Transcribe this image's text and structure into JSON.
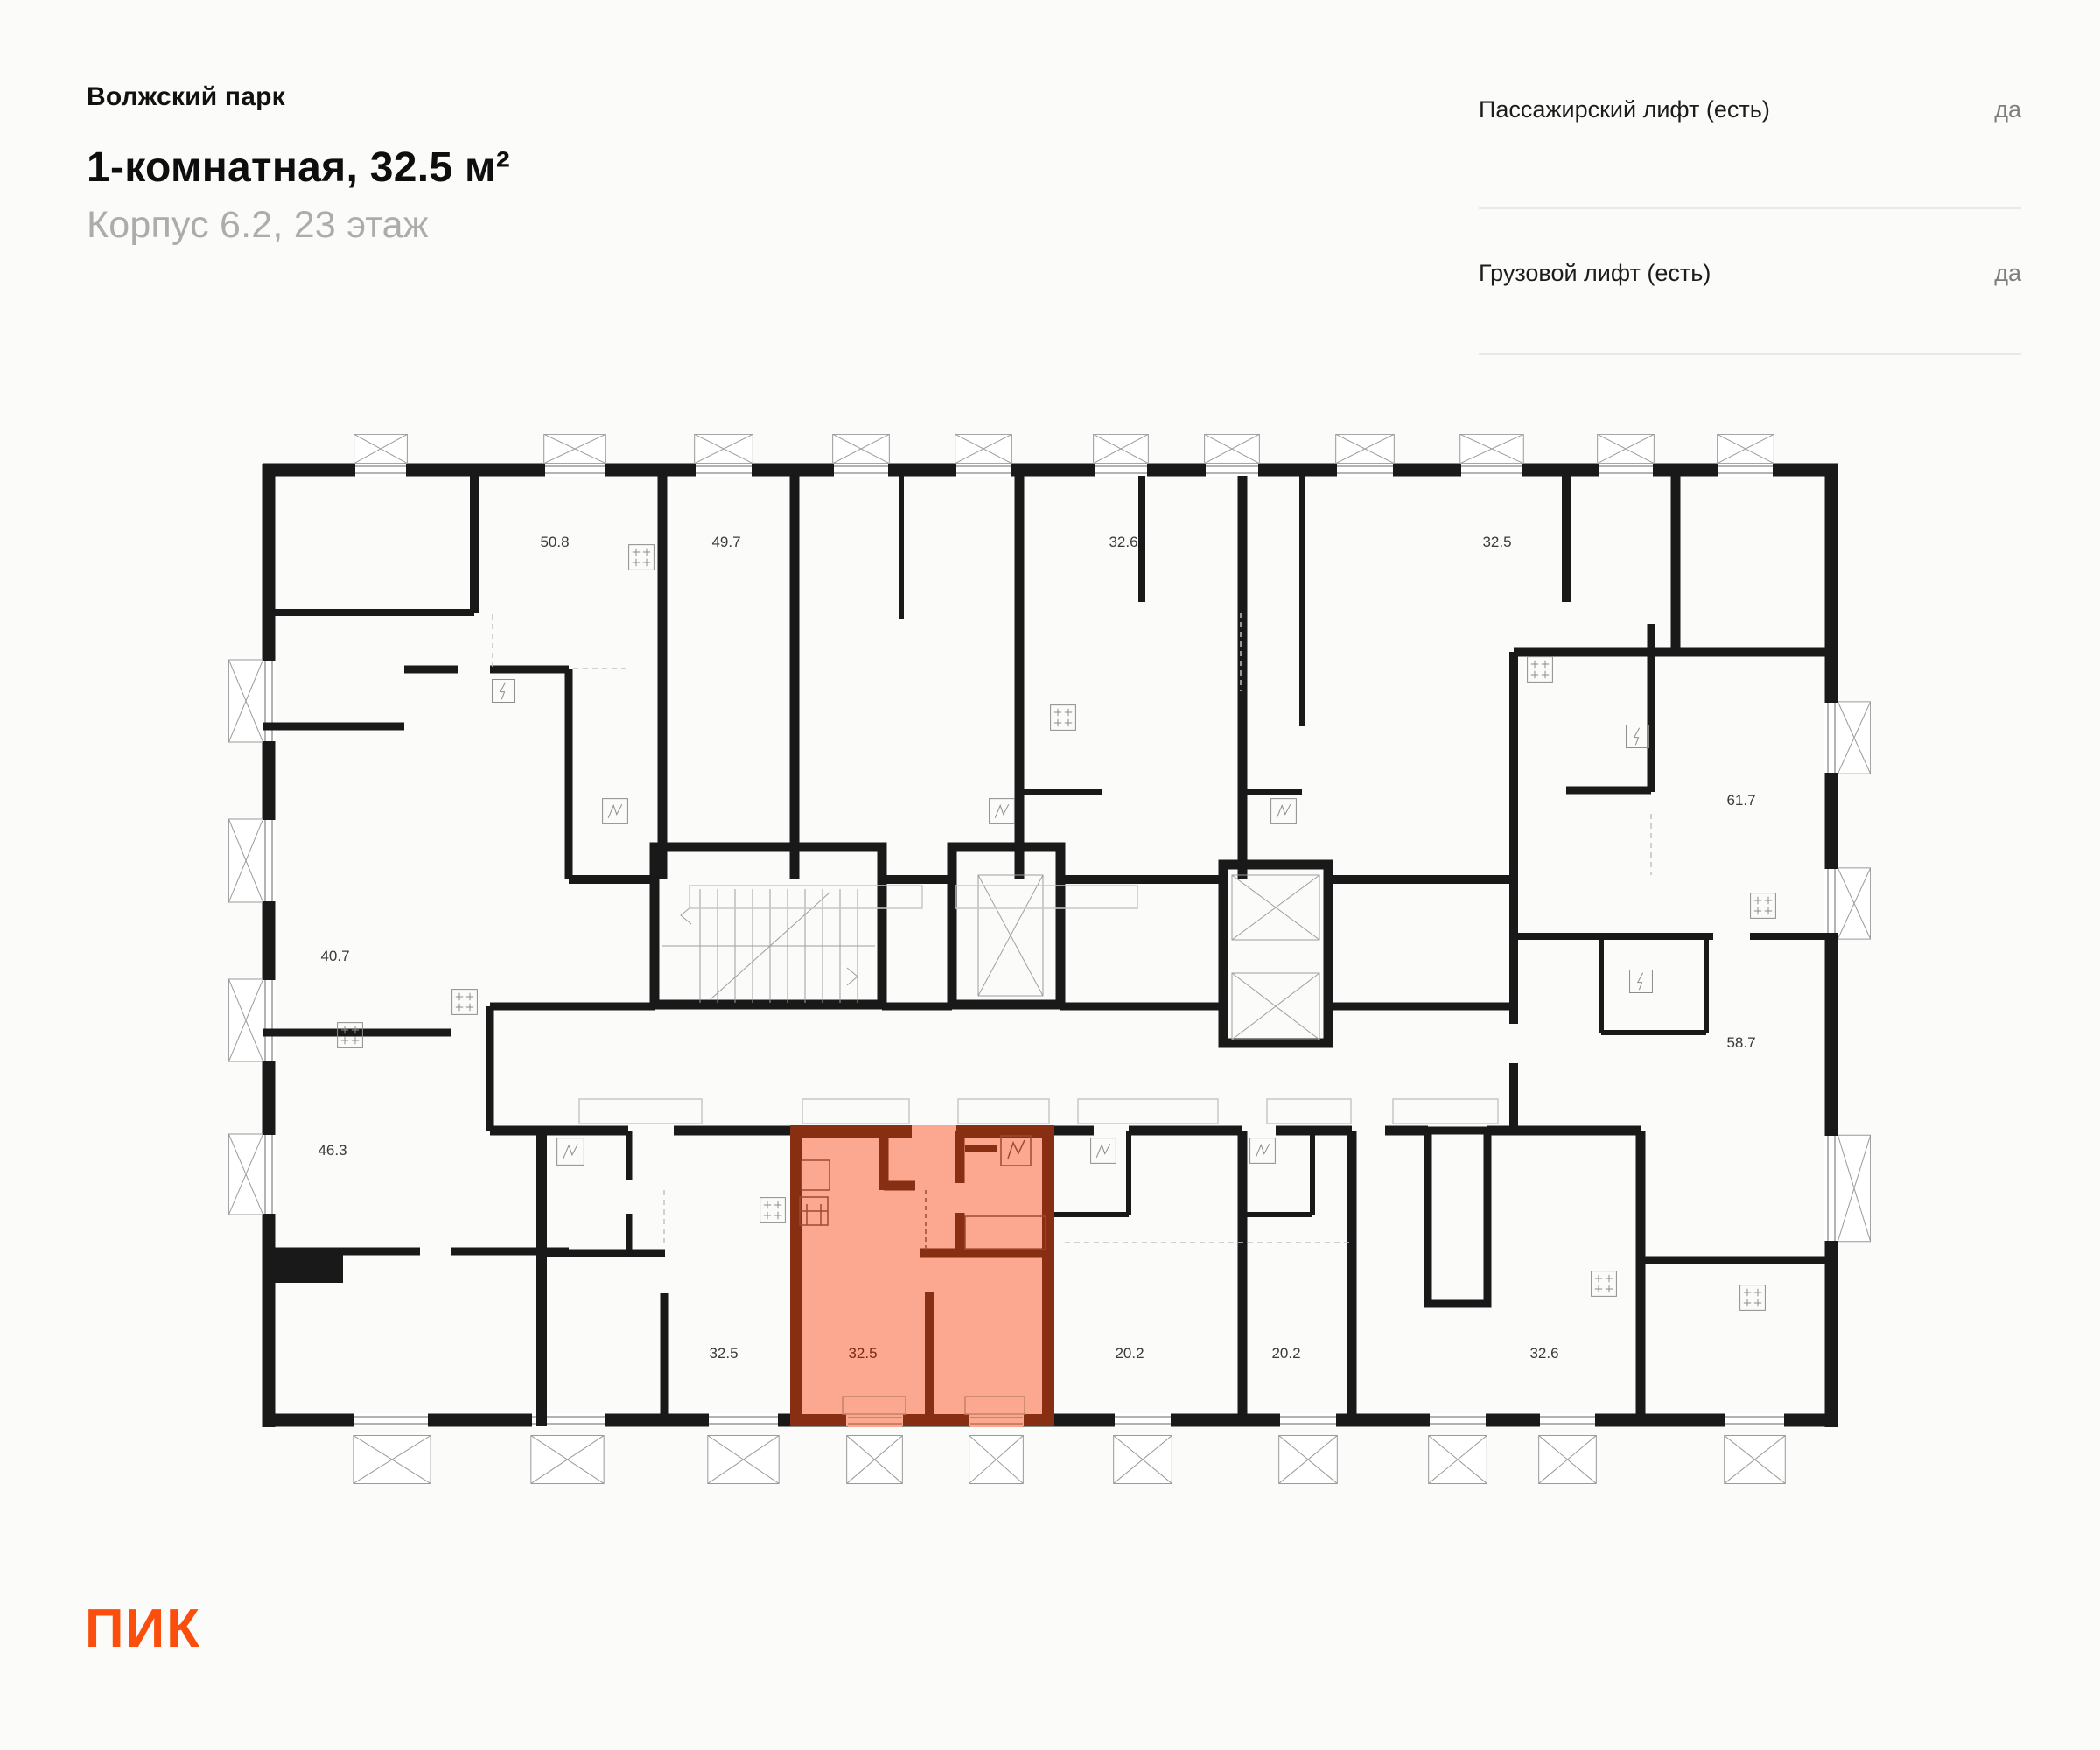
{
  "header": {
    "project": "Волжский парк",
    "title": "1-комнатная, 32.5 м²",
    "subtitle": "Корпус 6.2, 23 этаж"
  },
  "info_panel": {
    "rows": [
      {
        "label": "Пассажирский лифт (есть)",
        "value": "да"
      },
      {
        "label": "Грузовой лифт (есть)",
        "value": "да"
      }
    ]
  },
  "logo": {
    "text": "ПИК"
  },
  "floor_plan": {
    "highlighted_area": "32.5",
    "area_labels": [
      {
        "value": "50.8"
      },
      {
        "value": "49.7"
      },
      {
        "value": "32.6"
      },
      {
        "value": "32.5"
      },
      {
        "value": "61.7"
      },
      {
        "value": "40.7"
      },
      {
        "value": "46.3"
      },
      {
        "value": "58.7"
      },
      {
        "value": "32.5"
      },
      {
        "value": "32.5",
        "highlighted": true
      },
      {
        "value": "20.2"
      },
      {
        "value": "20.2"
      },
      {
        "value": "32.6"
      }
    ],
    "colors": {
      "wall": "#191919",
      "highlight_fill": "#FCA78F",
      "highlight_wall": "#872E13",
      "accent": "#FB4E0D"
    }
  }
}
